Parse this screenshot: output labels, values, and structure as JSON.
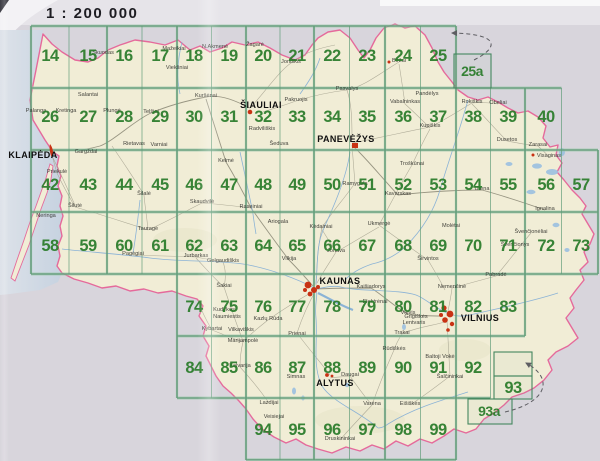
{
  "page": {
    "scale_label": "1 : 200 000"
  },
  "colors": {
    "sheet_number_green": "#2a7c2a",
    "grid_green": "#44875f",
    "border_pink": "#e56a9b",
    "land_cream": "#f1edd6",
    "outside_grey": "#d8d5dc",
    "sea_blue": "#cdd8e3",
    "water_blue": "#86b0d6",
    "city_marker_red": "#c83214"
  },
  "sheets": [
    {
      "label": "14",
      "x": 50,
      "y": 61
    },
    {
      "label": "15",
      "x": 88,
      "y": 61
    },
    {
      "label": "16",
      "x": 124,
      "y": 61
    },
    {
      "label": "17",
      "x": 160,
      "y": 61
    },
    {
      "label": "18",
      "x": 194,
      "y": 61
    },
    {
      "label": "19",
      "x": 229,
      "y": 61
    },
    {
      "label": "20",
      "x": 263,
      "y": 61
    },
    {
      "label": "21",
      "x": 297,
      "y": 61
    },
    {
      "label": "22",
      "x": 332,
      "y": 61
    },
    {
      "label": "23",
      "x": 367,
      "y": 61
    },
    {
      "label": "24",
      "x": 403,
      "y": 61
    },
    {
      "label": "25",
      "x": 438,
      "y": 61
    },
    {
      "label": "25a",
      "x": 472,
      "y": 76
    },
    {
      "label": "26",
      "x": 50,
      "y": 122
    },
    {
      "label": "27",
      "x": 88,
      "y": 122
    },
    {
      "label": "28",
      "x": 124,
      "y": 122
    },
    {
      "label": "29",
      "x": 160,
      "y": 122
    },
    {
      "label": "30",
      "x": 194,
      "y": 122
    },
    {
      "label": "31",
      "x": 229,
      "y": 122
    },
    {
      "label": "32",
      "x": 263,
      "y": 122
    },
    {
      "label": "33",
      "x": 297,
      "y": 122
    },
    {
      "label": "34",
      "x": 332,
      "y": 122
    },
    {
      "label": "35",
      "x": 367,
      "y": 122
    },
    {
      "label": "36",
      "x": 403,
      "y": 122
    },
    {
      "label": "37",
      "x": 438,
      "y": 122
    },
    {
      "label": "38",
      "x": 473,
      "y": 122
    },
    {
      "label": "39",
      "x": 508,
      "y": 122
    },
    {
      "label": "40",
      "x": 546,
      "y": 122
    },
    {
      "label": "42",
      "x": 50,
      "y": 190
    },
    {
      "label": "43",
      "x": 88,
      "y": 190
    },
    {
      "label": "44",
      "x": 124,
      "y": 190
    },
    {
      "label": "45",
      "x": 160,
      "y": 190
    },
    {
      "label": "46",
      "x": 194,
      "y": 190
    },
    {
      "label": "47",
      "x": 229,
      "y": 190
    },
    {
      "label": "48",
      "x": 263,
      "y": 190
    },
    {
      "label": "49",
      "x": 297,
      "y": 190
    },
    {
      "label": "50",
      "x": 332,
      "y": 190
    },
    {
      "label": "51",
      "x": 367,
      "y": 190
    },
    {
      "label": "52",
      "x": 403,
      "y": 190
    },
    {
      "label": "53",
      "x": 438,
      "y": 190
    },
    {
      "label": "54",
      "x": 473,
      "y": 190
    },
    {
      "label": "55",
      "x": 508,
      "y": 190
    },
    {
      "label": "56",
      "x": 546,
      "y": 190
    },
    {
      "label": "57",
      "x": 581,
      "y": 190
    },
    {
      "label": "58",
      "x": 50,
      "y": 251
    },
    {
      "label": "59",
      "x": 88,
      "y": 251
    },
    {
      "label": "60",
      "x": 124,
      "y": 251
    },
    {
      "label": "61",
      "x": 160,
      "y": 251
    },
    {
      "label": "62",
      "x": 194,
      "y": 251
    },
    {
      "label": "63",
      "x": 229,
      "y": 251
    },
    {
      "label": "64",
      "x": 263,
      "y": 251
    },
    {
      "label": "65",
      "x": 297,
      "y": 251
    },
    {
      "label": "66",
      "x": 332,
      "y": 251
    },
    {
      "label": "67",
      "x": 367,
      "y": 251
    },
    {
      "label": "68",
      "x": 403,
      "y": 251
    },
    {
      "label": "69",
      "x": 438,
      "y": 251
    },
    {
      "label": "70",
      "x": 473,
      "y": 251
    },
    {
      "label": "71",
      "x": 508,
      "y": 251
    },
    {
      "label": "72",
      "x": 546,
      "y": 251
    },
    {
      "label": "73",
      "x": 581,
      "y": 251
    },
    {
      "label": "74",
      "x": 194,
      "y": 312
    },
    {
      "label": "75",
      "x": 229,
      "y": 312
    },
    {
      "label": "76",
      "x": 263,
      "y": 312
    },
    {
      "label": "77",
      "x": 297,
      "y": 312
    },
    {
      "label": "78",
      "x": 332,
      "y": 312
    },
    {
      "label": "79",
      "x": 367,
      "y": 312
    },
    {
      "label": "80",
      "x": 403,
      "y": 312
    },
    {
      "label": "81",
      "x": 438,
      "y": 312
    },
    {
      "label": "82",
      "x": 473,
      "y": 312
    },
    {
      "label": "83",
      "x": 508,
      "y": 312
    },
    {
      "label": "84",
      "x": 194,
      "y": 373
    },
    {
      "label": "85",
      "x": 229,
      "y": 373
    },
    {
      "label": "86",
      "x": 263,
      "y": 373
    },
    {
      "label": "87",
      "x": 297,
      "y": 373
    },
    {
      "label": "88",
      "x": 332,
      "y": 373
    },
    {
      "label": "89",
      "x": 367,
      "y": 373
    },
    {
      "label": "90",
      "x": 403,
      "y": 373
    },
    {
      "label": "91",
      "x": 438,
      "y": 373
    },
    {
      "label": "92",
      "x": 473,
      "y": 373
    },
    {
      "label": "93",
      "x": 513,
      "y": 393
    },
    {
      "label": "93a",
      "x": 489,
      "y": 416
    },
    {
      "label": "94",
      "x": 263,
      "y": 435
    },
    {
      "label": "95",
      "x": 297,
      "y": 435
    },
    {
      "label": "96",
      "x": 332,
      "y": 435
    },
    {
      "label": "97",
      "x": 367,
      "y": 435
    },
    {
      "label": "98",
      "x": 403,
      "y": 435
    },
    {
      "label": "99",
      "x": 438,
      "y": 435
    }
  ],
  "cities": [
    {
      "name": "KLAIPĖDA",
      "x": 33,
      "y": 158
    },
    {
      "name": "ŠIAULIAI",
      "x": 261,
      "y": 108
    },
    {
      "name": "PANEVĖŽYS",
      "x": 346,
      "y": 142
    },
    {
      "name": "KAUNAS",
      "x": 340,
      "y": 284
    },
    {
      "name": "VILNIUS",
      "x": 480,
      "y": 321
    },
    {
      "name": "ALYTUS",
      "x": 335,
      "y": 386
    }
  ],
  "towns": [
    {
      "name": "Palanga",
      "x": 36,
      "y": 112
    },
    {
      "name": "Kretinga",
      "x": 66,
      "y": 112
    },
    {
      "name": "Salantai",
      "x": 88,
      "y": 96
    },
    {
      "name": "Skuodas",
      "x": 103,
      "y": 54
    },
    {
      "name": "Mažeikiai",
      "x": 174,
      "y": 50
    },
    {
      "name": "Viekšniai",
      "x": 177,
      "y": 69
    },
    {
      "name": "N.Akmenė",
      "x": 215,
      "y": 48
    },
    {
      "name": "Žagarė",
      "x": 255,
      "y": 46
    },
    {
      "name": "Joniškis",
      "x": 291,
      "y": 63
    },
    {
      "name": "Kuršėnai",
      "x": 206,
      "y": 97
    },
    {
      "name": "Pakruojis",
      "x": 296,
      "y": 101
    },
    {
      "name": "Plungė",
      "x": 112,
      "y": 112
    },
    {
      "name": "Telšiai",
      "x": 151,
      "y": 113
    },
    {
      "name": "Rietavas",
      "x": 134,
      "y": 145
    },
    {
      "name": "Varniai",
      "x": 159,
      "y": 146
    },
    {
      "name": "Kelmė",
      "x": 226,
      "y": 162
    },
    {
      "name": "Radviliškis",
      "x": 262,
      "y": 130
    },
    {
      "name": "Šeduva",
      "x": 279,
      "y": 145
    },
    {
      "name": "Biržai",
      "x": 399,
      "y": 62
    },
    {
      "name": "Pasvalys",
      "x": 347,
      "y": 90
    },
    {
      "name": "Vabalninkas",
      "x": 405,
      "y": 103
    },
    {
      "name": "Pandėlys",
      "x": 427,
      "y": 95
    },
    {
      "name": "Kupiškis",
      "x": 430,
      "y": 127
    },
    {
      "name": "Rokiškis",
      "x": 472,
      "y": 103
    },
    {
      "name": "Obeliai",
      "x": 498,
      "y": 104
    },
    {
      "name": "Dusetos",
      "x": 507,
      "y": 141
    },
    {
      "name": "Zarasai",
      "x": 538,
      "y": 146
    },
    {
      "name": "Visaginas",
      "x": 549,
      "y": 157
    },
    {
      "name": "Utena",
      "x": 482,
      "y": 190
    },
    {
      "name": "Molėtai",
      "x": 451,
      "y": 227
    },
    {
      "name": "Troškūnai",
      "x": 412,
      "y": 165
    },
    {
      "name": "Kavarskas",
      "x": 398,
      "y": 195
    },
    {
      "name": "Ramygala",
      "x": 355,
      "y": 185
    },
    {
      "name": "Ukmergė",
      "x": 379,
      "y": 225
    },
    {
      "name": "Širvintos",
      "x": 428,
      "y": 260
    },
    {
      "name": "Ignalina",
      "x": 545,
      "y": 210
    },
    {
      "name": "Švenčionėliai",
      "x": 531,
      "y": 233
    },
    {
      "name": "Švenčionys",
      "x": 515,
      "y": 246
    },
    {
      "name": "Pabradė",
      "x": 496,
      "y": 276
    },
    {
      "name": "Gargždai",
      "x": 86,
      "y": 153
    },
    {
      "name": "Priekulė",
      "x": 57,
      "y": 173
    },
    {
      "name": "Neringa",
      "x": 46,
      "y": 217
    },
    {
      "name": "Šilutė",
      "x": 75,
      "y": 207
    },
    {
      "name": "Šilalė",
      "x": 144,
      "y": 195
    },
    {
      "name": "Tauragė",
      "x": 148,
      "y": 230
    },
    {
      "name": "Skaudvilė",
      "x": 202,
      "y": 203
    },
    {
      "name": "Raseiniai",
      "x": 251,
      "y": 208
    },
    {
      "name": "Ariogala",
      "x": 278,
      "y": 223
    },
    {
      "name": "Pagėgiai",
      "x": 133,
      "y": 255
    },
    {
      "name": "Jurbarkas",
      "x": 196,
      "y": 257
    },
    {
      "name": "Gelgaudiškis",
      "x": 223,
      "y": 262
    },
    {
      "name": "Šakiai",
      "x": 224,
      "y": 287
    },
    {
      "name": "Vilkija",
      "x": 289,
      "y": 260
    },
    {
      "name": "Kėdainiai",
      "x": 321,
      "y": 228
    },
    {
      "name": "Jonava",
      "x": 336,
      "y": 252
    },
    {
      "name": "Kudirkos",
      "x": 224,
      "y": 311
    },
    {
      "name": "Naumiestis",
      "x": 227,
      "y": 318
    },
    {
      "name": "Kybartai",
      "x": 212,
      "y": 330
    },
    {
      "name": "Vilkaviškis",
      "x": 241,
      "y": 331
    },
    {
      "name": "Kazlų Rūda",
      "x": 268,
      "y": 320
    },
    {
      "name": "Marijampolė",
      "x": 243,
      "y": 342
    },
    {
      "name": "Kalvarija",
      "x": 240,
      "y": 367
    },
    {
      "name": "Simnas",
      "x": 296,
      "y": 378
    },
    {
      "name": "Prienai",
      "x": 297,
      "y": 335
    },
    {
      "name": "Kaišiadorys",
      "x": 371,
      "y": 288
    },
    {
      "name": "Elektrėnai",
      "x": 375,
      "y": 303
    },
    {
      "name": "Vievis",
      "x": 408,
      "y": 314
    },
    {
      "name": "Grigiškės",
      "x": 416,
      "y": 318
    },
    {
      "name": "Lentvaris",
      "x": 414,
      "y": 324
    },
    {
      "name": "Trakai",
      "x": 402,
      "y": 334
    },
    {
      "name": "Nemenčinė",
      "x": 452,
      "y": 288
    },
    {
      "name": "Rūdiškės",
      "x": 394,
      "y": 350
    },
    {
      "name": "Baltoji Vokė",
      "x": 440,
      "y": 358
    },
    {
      "name": "Šalčininkai",
      "x": 450,
      "y": 378
    },
    {
      "name": "Daugai",
      "x": 350,
      "y": 376
    },
    {
      "name": "Varėna",
      "x": 372,
      "y": 405
    },
    {
      "name": "Eišiškės",
      "x": 410,
      "y": 405
    },
    {
      "name": "Lazdijai",
      "x": 269,
      "y": 404
    },
    {
      "name": "Veisiejai",
      "x": 274,
      "y": 418
    },
    {
      "name": "Druskininkai",
      "x": 340,
      "y": 440
    }
  ]
}
